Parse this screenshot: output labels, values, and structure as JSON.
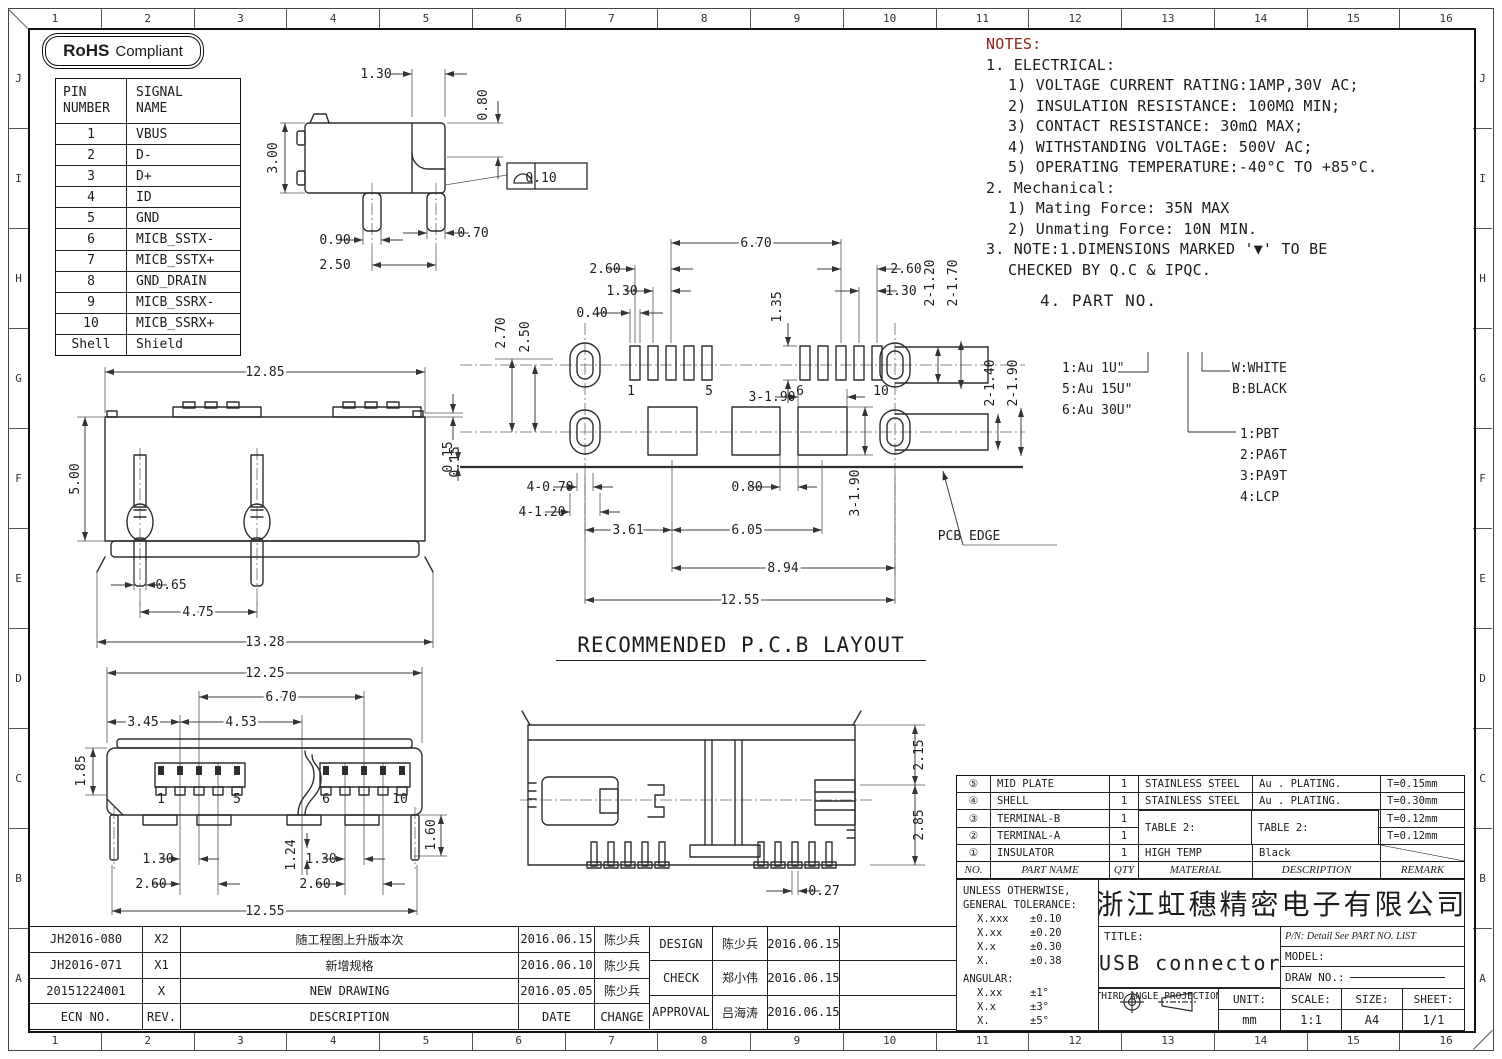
{
  "frame": {
    "cols": [
      "1",
      "2",
      "3",
      "4",
      "5",
      "6",
      "7",
      "8",
      "9",
      "10",
      "11",
      "12",
      "13",
      "14",
      "15",
      "16"
    ],
    "rows": [
      "J",
      "I",
      "H",
      "G",
      "F",
      "E",
      "D",
      "C",
      "B",
      "A"
    ]
  },
  "badge": {
    "bold": "RoHS",
    "rest": "Compliant"
  },
  "pin_table": {
    "header_col1": "PIN\nNUMBER",
    "header_col2": "SIGNAL\nNAME",
    "rows": [
      [
        "1",
        "VBUS"
      ],
      [
        "2",
        "D-"
      ],
      [
        "3",
        "D+"
      ],
      [
        "4",
        "ID"
      ],
      [
        "5",
        "GND"
      ],
      [
        "6",
        "MICB_SSTX-"
      ],
      [
        "7",
        "MICB_SSTX+"
      ],
      [
        "8",
        "GND_DRAIN"
      ],
      [
        "9",
        "MICB_SSRX-"
      ],
      [
        "10",
        "MICB_SSRX+"
      ],
      [
        "Shell",
        "Shield"
      ]
    ]
  },
  "notes": {
    "title": "NOTES:",
    "lines": [
      {
        "t": "1. ELECTRICAL:",
        "ind": 0
      },
      {
        "t": "1) VOLTAGE CURRENT RATING:1AMP,30V AC;",
        "ind": 1
      },
      {
        "t": "2) INSULATION RESISTANCE: 100MΩ MIN;",
        "ind": 1
      },
      {
        "t": "3) CONTACT RESISTANCE: 30mΩ MAX;",
        "ind": 1
      },
      {
        "t": "4) WITHSTANDING VOLTAGE: 500V AC;",
        "ind": 1
      },
      {
        "t": "5) OPERATING TEMPERATURE:-40°C TO +85°C.",
        "ind": 1
      },
      {
        "t": "2. Mechanical:",
        "ind": 0
      },
      {
        "t": "1) Mating Force:  35N MAX",
        "ind": 1
      },
      {
        "t": "2) Unmating Force:  10N MIN.",
        "ind": 1
      },
      {
        "t": "3. NOTE:1.DIMENSIONS MARKED '▼' TO BE",
        "ind": 0
      },
      {
        "t": "CHECKED BY Q.C & IPQC.",
        "ind": 1
      }
    ]
  },
  "part_no": {
    "title": "4. PART NO.",
    "plating": [
      "1:Au 1U\"",
      "5:Au 15U\"",
      "6:Au 30U\""
    ],
    "colors": [
      "W:WHITE",
      "B:BLACK"
    ],
    "materials": [
      "1:PBT",
      "2:PA6T",
      "3:PA9T",
      "4:LCP"
    ]
  },
  "pcb_title": "RECOMMENDED P.C.B LAYOUT",
  "views": {
    "side": {
      "dims": [
        {
          "t": "1.30",
          "x": 121,
          "y": 23,
          "a": "end"
        },
        {
          "t": "0.80",
          "x": 232,
          "y": 50,
          "r": -90
        },
        {
          "t": "3.00",
          "x": 22,
          "y": 103,
          "r": -90
        },
        {
          "t": "0.90",
          "x": 80,
          "y": 189,
          "a": "end"
        },
        {
          "t": "2.50",
          "x": 80,
          "y": 214,
          "a": "end"
        },
        {
          "t": "0.70",
          "x": 218,
          "y": 182,
          "a": "start"
        },
        {
          "t": "0.10",
          "x": 286,
          "y": 127,
          "a": "start"
        }
      ]
    },
    "back": {
      "dims": [
        {
          "t": "12.85",
          "x": 210,
          "y": 16,
          "k": 1
        },
        {
          "t": "5.00",
          "x": 24,
          "y": 119,
          "r": -90
        },
        {
          "t": "0.15",
          "x": 404,
          "y": 102,
          "r": -90
        },
        {
          "t": "0.65",
          "x": 116,
          "y": 229,
          "a": "start"
        },
        {
          "t": "4.75",
          "x": 143,
          "y": 256,
          "k": 1
        },
        {
          "t": "13.28",
          "x": 210,
          "y": 286,
          "k": 1
        }
      ]
    },
    "front": {
      "dims": [
        {
          "t": "12.25",
          "x": 210,
          "y": 22,
          "k": 1
        },
        {
          "t": "6.70",
          "x": 226,
          "y": 46,
          "k": 1
        },
        {
          "t": "3.45",
          "x": 88,
          "y": 71,
          "k": 1
        },
        {
          "t": "4.53",
          "x": 186,
          "y": 71,
          "k": 1
        },
        {
          "t": "1.85",
          "x": 30,
          "y": 116,
          "r": -90
        },
        {
          "t": "1.60",
          "x": 380,
          "y": 180,
          "r": -90
        },
        {
          "t": "1.30",
          "x": 103,
          "y": 208,
          "a": "end"
        },
        {
          "t": "2.60",
          "x": 96,
          "y": 233,
          "a": "end"
        },
        {
          "t": "1.24",
          "x": 240,
          "y": 200,
          "r": -90
        },
        {
          "t": "1.30",
          "x": 266,
          "y": 208,
          "a": "end"
        },
        {
          "t": "2.60",
          "x": 260,
          "y": 233,
          "a": "end"
        },
        {
          "t": "12.55",
          "x": 210,
          "y": 260,
          "k": 1
        },
        {
          "t": "1",
          "x": 106,
          "y": 148,
          "fs": 10
        },
        {
          "t": "5",
          "x": 182,
          "y": 148,
          "fs": 10
        },
        {
          "t": "6",
          "x": 271,
          "y": 148,
          "fs": 10
        },
        {
          "t": "10",
          "x": 345,
          "y": 148,
          "fs": 10
        }
      ]
    },
    "pcb": {
      "dims": [
        {
          "t": "6.70",
          "x": 311,
          "y": 22,
          "k": 1
        },
        {
          "t": "2.60",
          "x": 160,
          "y": 48,
          "a": "end"
        },
        {
          "t": "1.30",
          "x": 177,
          "y": 70,
          "a": "end"
        },
        {
          "t": "0.40",
          "x": 147,
          "y": 92,
          "a": "end"
        },
        {
          "t": "2.70",
          "x": 60,
          "y": 108,
          "r": -90
        },
        {
          "t": "2.50",
          "x": 84,
          "y": 112,
          "r": -90
        },
        {
          "t": "1.35",
          "x": 336,
          "y": 82,
          "r": -90
        },
        {
          "t": "2.60",
          "x": 461,
          "y": 48,
          "a": "start"
        },
        {
          "t": "1.30",
          "x": 456,
          "y": 70,
          "a": "start"
        },
        {
          "t": "2-1.20",
          "x": 489,
          "y": 58,
          "r": -90
        },
        {
          "t": "2-1.70",
          "x": 512,
          "y": 58,
          "r": -90
        },
        {
          "t": "2-1.40",
          "x": 549,
          "y": 158,
          "r": -90
        },
        {
          "t": "2-1.90",
          "x": 572,
          "y": 158,
          "r": -90
        },
        {
          "t": "3-1.90",
          "x": 327,
          "y": 176,
          "a": "end"
        },
        {
          "t": "0.15",
          "x": 7,
          "y": 232,
          "r": -90
        },
        {
          "t": "4-0.70",
          "x": 105,
          "y": 266,
          "a": "end"
        },
        {
          "t": "4-1.20",
          "x": 97,
          "y": 291,
          "a": "end"
        },
        {
          "t": "0.80",
          "x": 302,
          "y": 266,
          "a": "end"
        },
        {
          "t": "3-1.90",
          "x": 414,
          "y": 268,
          "r": -90
        },
        {
          "t": "3.61",
          "x": 183,
          "y": 309,
          "k": 1
        },
        {
          "t": "6.05",
          "x": 302,
          "y": 309,
          "k": 1
        },
        {
          "t": "8.94",
          "x": 338,
          "y": 347,
          "k": 1
        },
        {
          "t": "12.55",
          "x": 295,
          "y": 379,
          "k": 1
        },
        {
          "t": "1",
          "x": 186,
          "y": 170,
          "fs": 10
        },
        {
          "t": "5",
          "x": 264,
          "y": 170,
          "fs": 10
        },
        {
          "t": "6",
          "x": 355,
          "y": 170,
          "fs": 10
        },
        {
          "t": "10",
          "x": 436,
          "y": 170,
          "fs": 10
        },
        {
          "t": "PCB EDGE",
          "x": 524,
          "y": 315,
          "a": "start"
        }
      ]
    },
    "bottom": {
      "dims": [
        {
          "t": "2.15",
          "x": 403,
          "y": 60,
          "r": -90
        },
        {
          "t": "2.85",
          "x": 403,
          "y": 130,
          "r": -90
        },
        {
          "t": "0.27",
          "x": 304,
          "y": 200,
          "a": "start"
        }
      ]
    }
  },
  "revision_table": {
    "rows": [
      [
        "JH2016-080",
        "X2",
        "随工程图上升版本次",
        "2016.06.15",
        "陈少兵"
      ],
      [
        "JH2016-071",
        "X1",
        "新增规格",
        "2016.06.10",
        "陈少兵"
      ],
      [
        "20151224001",
        "X",
        "NEW DRAWING",
        "2016.05.05",
        "陈少兵"
      ],
      [
        "ECN NO.",
        "REV.",
        "DESCRIPTION",
        "DATE",
        "CHANGE"
      ]
    ]
  },
  "approval_table": {
    "rows": [
      [
        "DESIGN",
        "陈少兵",
        "2016.06.15",
        ""
      ],
      [
        "CHECK",
        "郑小伟",
        "2016.06.15",
        ""
      ],
      [
        "APPROVAL",
        "吕海涛",
        "2016.06.15",
        ""
      ]
    ]
  },
  "parts_table": {
    "rows": [
      [
        "⑤",
        "MID PLATE",
        "1",
        "STAINLESS STEEL",
        "Au . PLATING.",
        "T=0.15mm"
      ],
      [
        "④",
        "SHELL",
        "1",
        "STAINLESS STEEL",
        "Au . PLATING.",
        "T=0.30mm"
      ],
      [
        "③",
        "TERMINAL-B",
        "1",
        "",
        "",
        "T=0.12mm"
      ],
      [
        "②",
        "TERMINAL-A",
        "1",
        "",
        "",
        "T=0.12mm"
      ],
      [
        "①",
        "INSULATOR",
        "1",
        "HIGH TEMP",
        "Black",
        ""
      ]
    ],
    "header_row": [
      [
        "NO.",
        "PART NAME",
        "QTY",
        "MATERIAL",
        "DESCRIPTION",
        "REMARK"
      ]
    ],
    "table2_material": "TABLE 2:",
    "table2_description": "TABLE 2:"
  },
  "tolerance_block": {
    "line1": "UNLESS OTHERWISE,",
    "line2": "GENERAL TOLERANCE:",
    "pairs": [
      [
        "X.xxx",
        "±0.10"
      ],
      [
        "X.xx",
        "±0.20"
      ],
      [
        "X.x",
        "±0.30"
      ],
      [
        "X.",
        "±0.38"
      ]
    ],
    "angular_label": "ANGULAR:",
    "angular_pairs": [
      [
        "X.xx",
        "±1°"
      ],
      [
        "X.x",
        "±3°"
      ],
      [
        "X.",
        "±5°"
      ]
    ]
  },
  "title_block": {
    "company": "浙江虹穗精密电子有限公司",
    "title_label": "TITLE:",
    "title": "USB connector",
    "pn": "P/N: Detail See PART NO. LIST",
    "model_label": "MODEL:",
    "draw_no_label": "DRAW NO.:",
    "projection_label": "THIRD ANGLE PROJECTION",
    "unit_label": "UNIT:",
    "unit": "mm",
    "scale_label": "SCALE:",
    "scale": "1:1",
    "size_label": "SIZE:",
    "size": "A4",
    "sheet_label": "SHEET:",
    "sheet": "1/1"
  }
}
